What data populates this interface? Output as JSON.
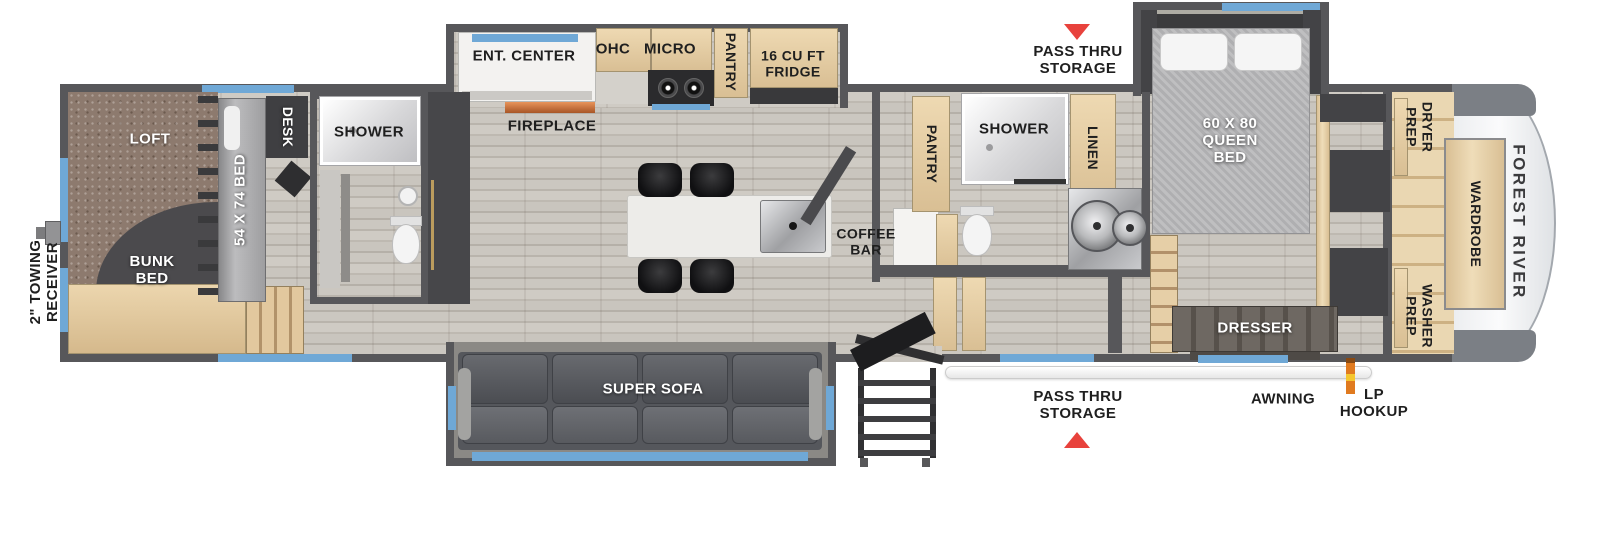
{
  "plan": {
    "brand": "FOREST RIVER",
    "exterior": {
      "towing_receiver": "2\" TOWING RECEIVER",
      "pass_thru_top": "PASS THRU STORAGE",
      "pass_thru_bottom": "PASS THRU STORAGE",
      "awning": "AWNING",
      "lp_hookup": "LP HOOKUP"
    },
    "bunk_room": {
      "loft": "LOFT",
      "bunk_bed": "BUNK BED",
      "bed_size": "54 X 74 BED",
      "desk": "DESK",
      "shower": "SHOWER"
    },
    "kitchen": {
      "ent_center": "ENT. CENTER",
      "fireplace": "FIREPLACE",
      "ohc": "OHC",
      "micro": "MICRO",
      "pantry": "PANTRY",
      "fridge": "16 CU FT FRIDGE",
      "coffee_bar": "COFFEE BAR"
    },
    "living": {
      "super_sofa": "SUPER SOFA"
    },
    "bathroom": {
      "pantry": "PANTRY",
      "shower": "SHOWER",
      "linen": "LINEN"
    },
    "bedroom": {
      "queen_bed": "60 X 80 QUEEN BED",
      "dresser": "DRESSER"
    },
    "front_closet": {
      "dryer_prep": "DRYER PREP",
      "wardrobe": "WARDROBE",
      "washer_prep": "WASHER PREP"
    }
  },
  "colors": {
    "wall": "#57575a",
    "floor": "#c6c2bb",
    "accent-blue": "#6fa8d6",
    "arrow-red": "#e8423c",
    "cabinet-tan": "#e5cda5",
    "loft-carpet": "#8d7a6e",
    "sofa-gray": "#5c5e63",
    "lp-orange": "#e07a1f",
    "label-dark": "#1f1f1f"
  }
}
